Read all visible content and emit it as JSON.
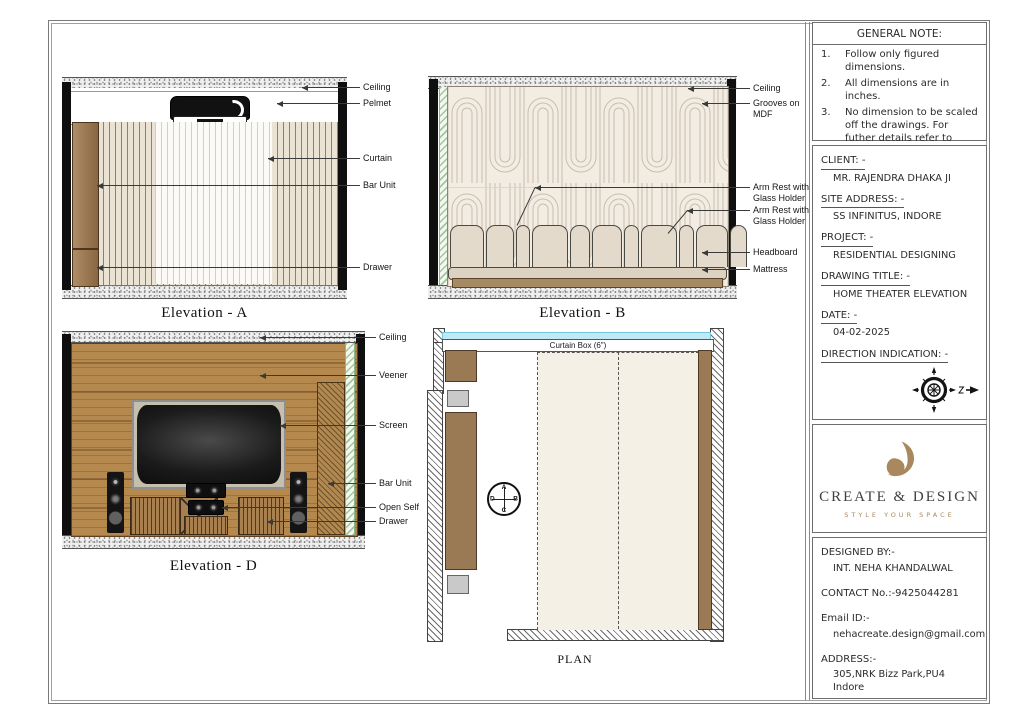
{
  "sheet": {
    "elevations": {
      "a": {
        "title": "Elevation - A",
        "labels": {
          "ceiling": "Ceiling",
          "pelmet": "Pelmet",
          "curtain": "Curtain",
          "bar_unit": "Bar Unit",
          "drawer": "Drawer"
        }
      },
      "b": {
        "title": "Elevation - B",
        "labels": {
          "ceiling": "Ceiling",
          "grooves": "Grooves on MDF",
          "arm_rest_1": "Arm Rest with Glass Holder",
          "arm_rest_2": "Arm Rest with Glass Holder",
          "headboard": "Headboard",
          "mattress": "Mattress"
        }
      },
      "d": {
        "title": "Elevation - D",
        "labels": {
          "ceiling": "Ceiling",
          "veener": "Veener",
          "screen": "Screen",
          "bar_unit": "Bar Unit",
          "open_self": "Open Self",
          "drawer": "Drawer"
        }
      }
    },
    "plan": {
      "title": "PLAN",
      "curtain_box": "Curtain Box (6\")",
      "marker": {
        "top": "A",
        "right": "B",
        "bottom": "C",
        "left": "D"
      }
    }
  },
  "title_block": {
    "general_note": {
      "title": "GENERAL NOTE:",
      "items": [
        {
          "num": "1.",
          "text": "Follow only figured dimensions."
        },
        {
          "num": "2.",
          "text": "All dimensions are in inches."
        },
        {
          "num": "3.",
          "text": "No dimension to be scaled off the drawings. For futher details refer to relevant drawings."
        }
      ]
    },
    "info": {
      "client_label": "CLIENT: -",
      "client_value": "MR. RAJENDRA DHAKA JI",
      "site_label": "SITE ADDRESS: -",
      "site_value": "SS INFINITUS, INDORE",
      "project_label": "PROJECT: -",
      "project_value": "RESIDENTIAL DESIGNING",
      "drawing_title_label": "DRAWING TITLE: -",
      "drawing_title_value": "HOME THEATER ELEVATION",
      "date_label": "DATE: -",
      "date_value": "04-02-2025",
      "direction_label": "DIRECTION INDICATION: -"
    },
    "brand": {
      "name": "CREATE & DESIGN",
      "tagline": "STYLE YOUR SPACE"
    },
    "credits": {
      "designed_by_label": "DESIGNED BY:-",
      "designed_by_value": "INT. NEHA KHANDALWAL",
      "contact": "CONTACT No.:-9425044281",
      "email_label": "Email ID:-",
      "email_value": "nehacreate.design@gmail.com",
      "address_label": "ADDRESS:-",
      "address_value": "305,NRK Bizz Park,PU4 Indore"
    }
  },
  "colors": {
    "brand_accent": "#a8885c",
    "wood": "#b5884e",
    "cabinet_brown": "#9c7447",
    "wall_cream": "#f2ece2",
    "curtain_box_cyan": "#bfe9f4",
    "hatch_green": "#9ec79b"
  }
}
